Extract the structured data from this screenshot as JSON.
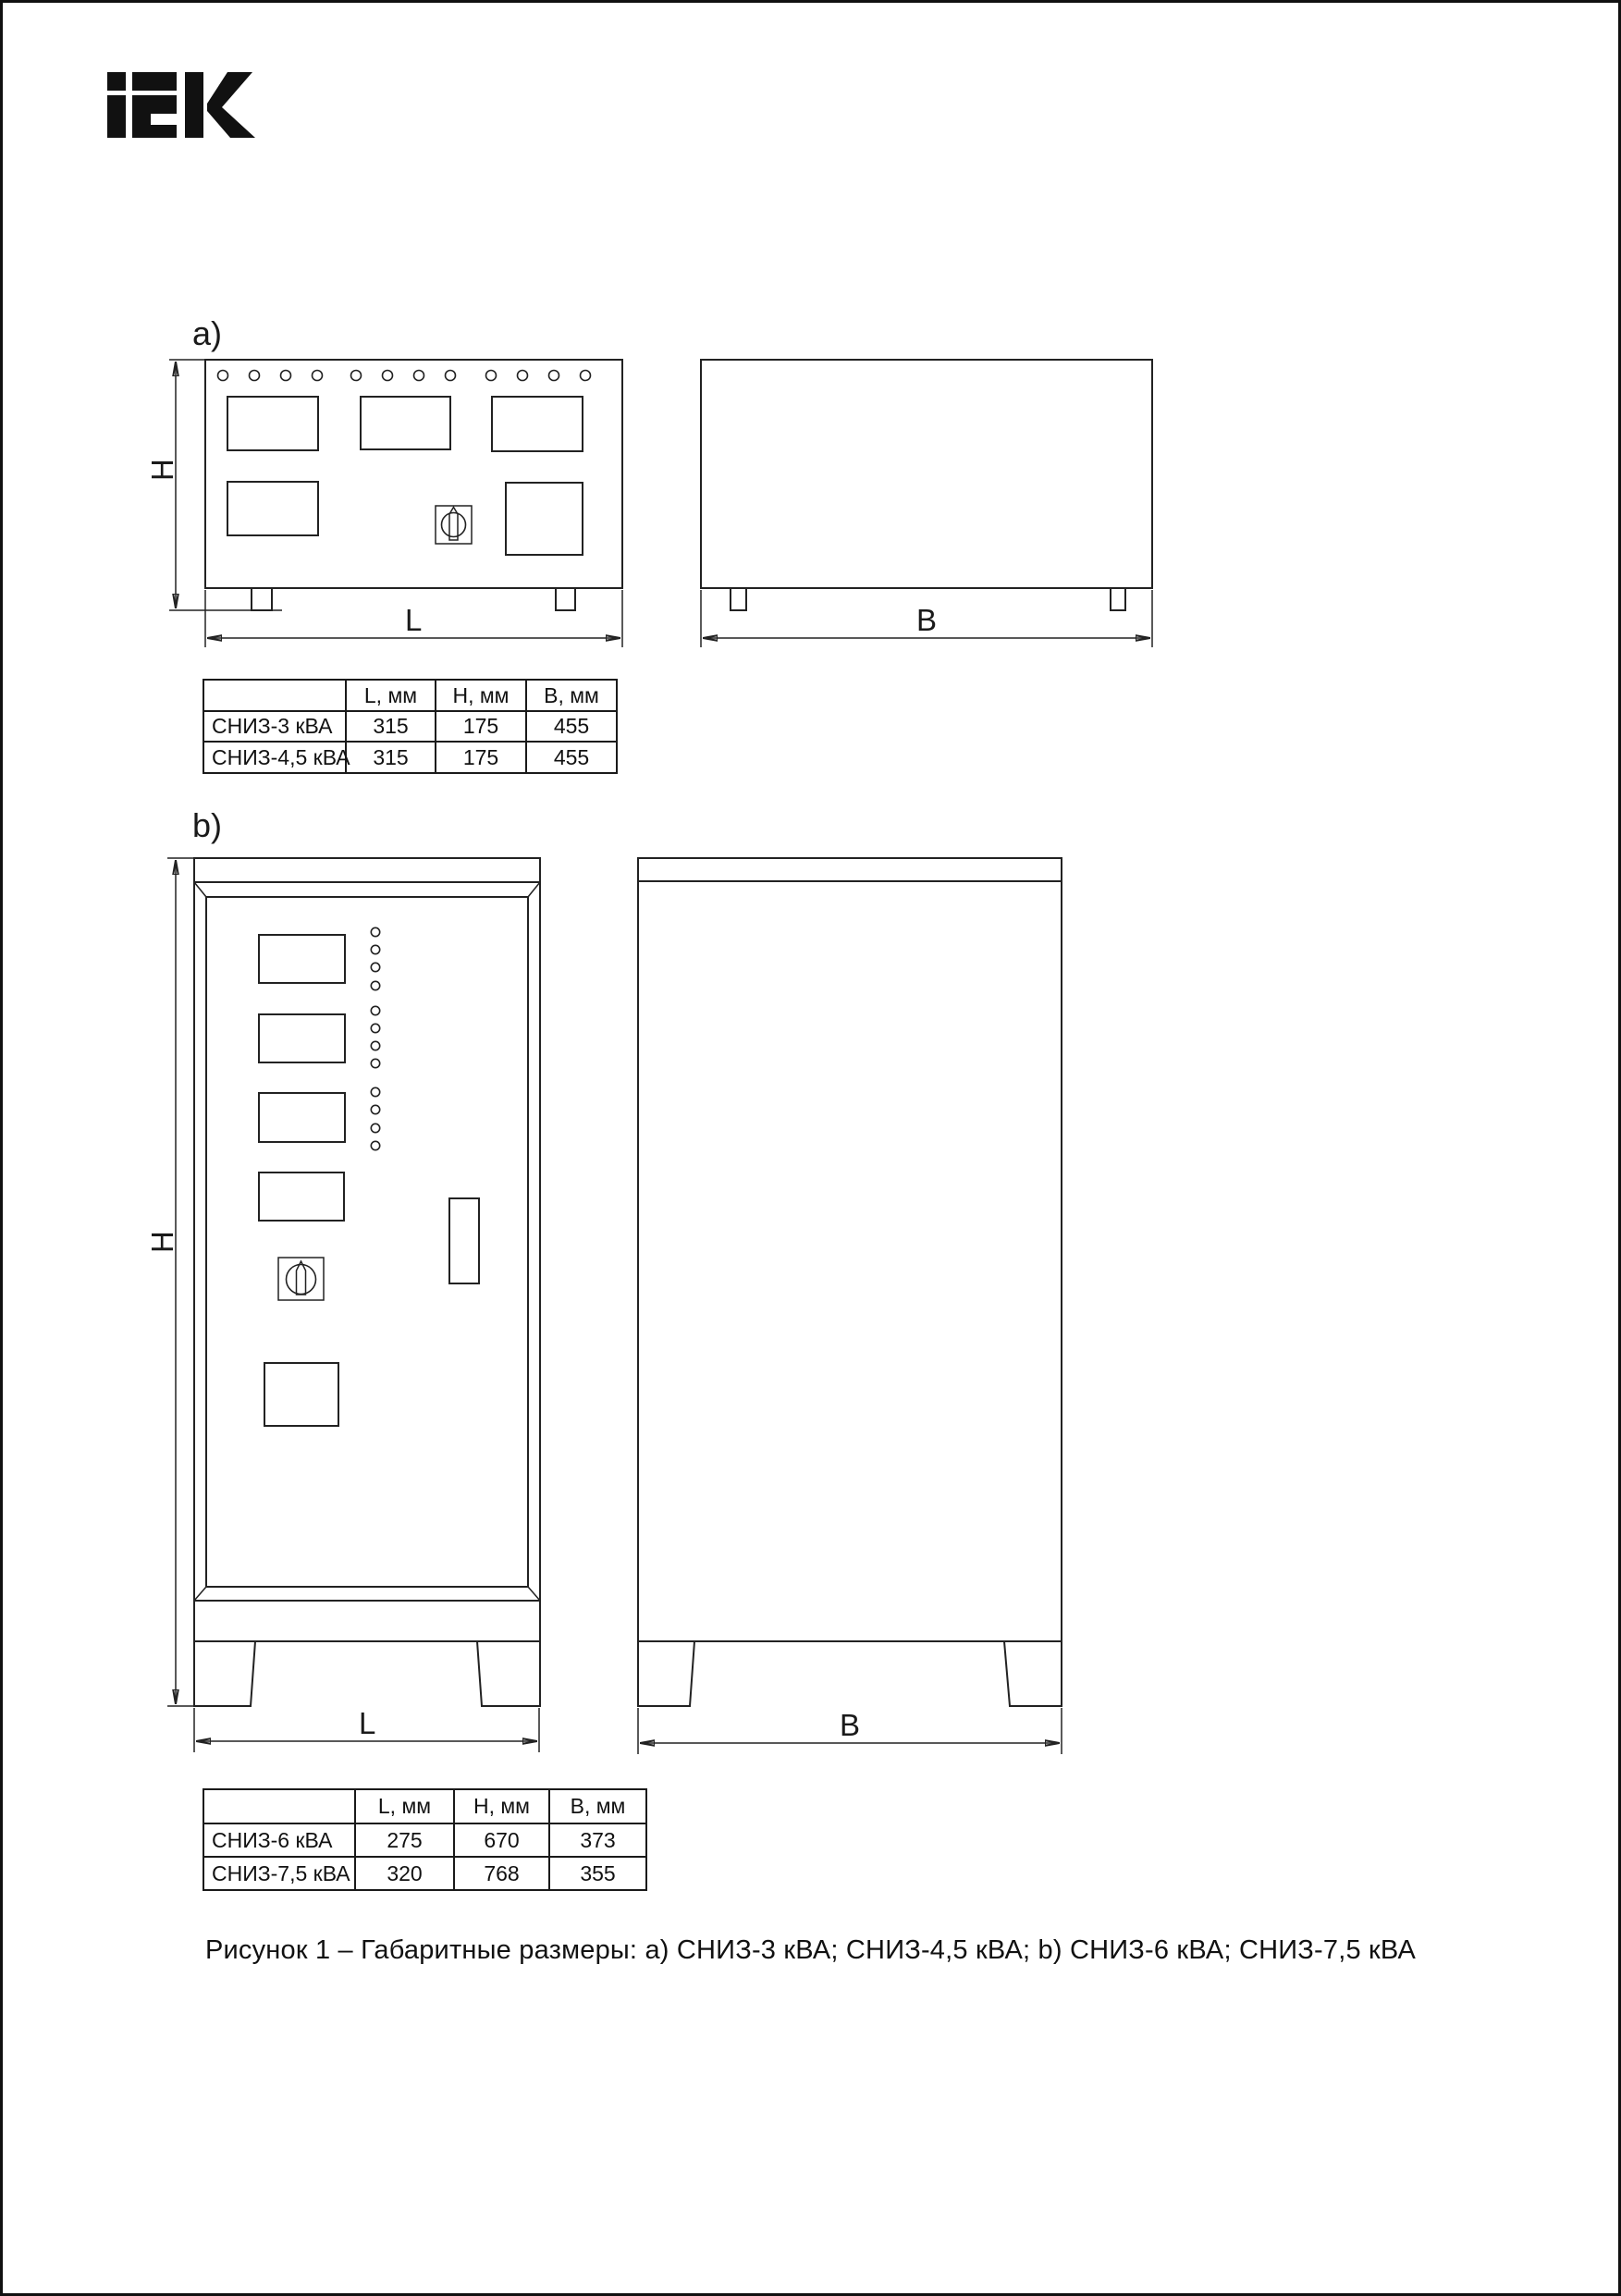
{
  "logo": {
    "brand": "iEK"
  },
  "figure": {
    "caption": "Рисунок 1 – Габаритные размеры: a) СНИЗ-3 кВА; СНИЗ-4,5 кВА; b) СНИЗ-6 кВА; СНИЗ-7,5 кВА"
  },
  "drawing_a": {
    "label": "a)",
    "dims": {
      "h": "H",
      "l": "L",
      "b": "B"
    },
    "table": {
      "headers": [
        "",
        "L, мм",
        "H, мм",
        "B, мм"
      ],
      "rows": [
        {
          "name": "СНИЗ-3 кВА",
          "l": "315",
          "h": "175",
          "b": "455"
        },
        {
          "name": "СНИЗ-4,5 кВА",
          "l": "315",
          "h": "175",
          "b": "455"
        }
      ]
    }
  },
  "drawing_b": {
    "label": "b)",
    "dims": {
      "h": "H",
      "l": "L",
      "b": "B"
    },
    "table": {
      "headers": [
        "",
        "L, мм",
        "H, мм",
        "B, мм"
      ],
      "rows": [
        {
          "name": "СНИЗ-6 кВА",
          "l": "275",
          "h": "670",
          "b": "373"
        },
        {
          "name": "СНИЗ-7,5 кВА",
          "l": "320",
          "h": "768",
          "b": "355"
        }
      ]
    }
  },
  "colors": {
    "background": "#ffffff",
    "line": "#222222",
    "table_border": "#1a1a1a",
    "logo": "#111111"
  }
}
